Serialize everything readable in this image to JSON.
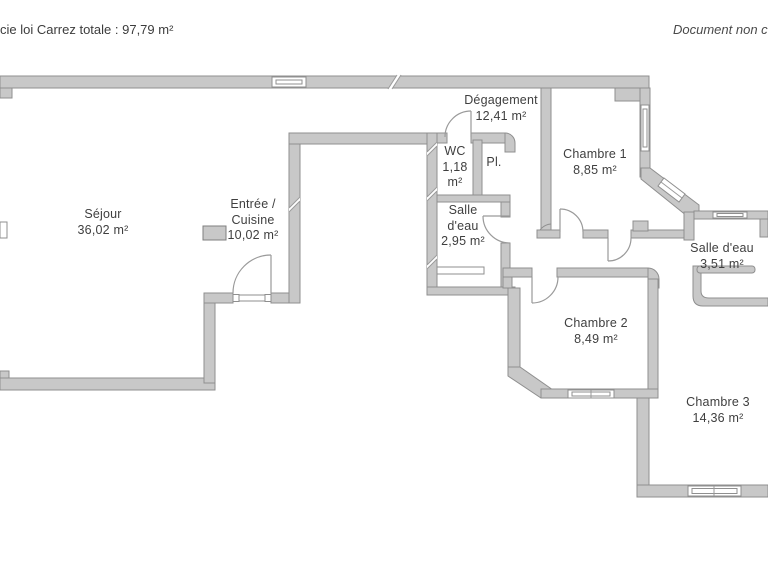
{
  "header": {
    "left_text": "cie loi Carrez totale :  97,79 m²",
    "right_text": "Document non con"
  },
  "palette": {
    "background": "#ffffff",
    "wall_fill": "#c8c8c8",
    "wall_stroke": "#8f8f8f",
    "text": "#3f3f3f"
  },
  "rooms": {
    "sejour": {
      "name": "Séjour",
      "area": "36,02 m²"
    },
    "entree": {
      "name": "Entrée /",
      "name2": "Cuisine",
      "area": "10,02 m²"
    },
    "degagement": {
      "name": "Dégagement",
      "area": "12,41 m²"
    },
    "wc": {
      "name": "WC",
      "area": "1,18",
      "area_unit": "m²"
    },
    "placard": {
      "name": "Pl."
    },
    "chambre1": {
      "name": "Chambre 1",
      "area": "8,85 m²"
    },
    "salle_eau_1": {
      "name": "Salle",
      "name2": "d'eau",
      "area": "2,95 m²"
    },
    "salle_eau_2": {
      "name": "Salle d'eau",
      "area": "3,51 m²"
    },
    "chambre2": {
      "name": "Chambre 2",
      "area": "8,49 m²"
    },
    "chambre3": {
      "name": "Chambre 3",
      "area": "14,36 m²"
    }
  }
}
